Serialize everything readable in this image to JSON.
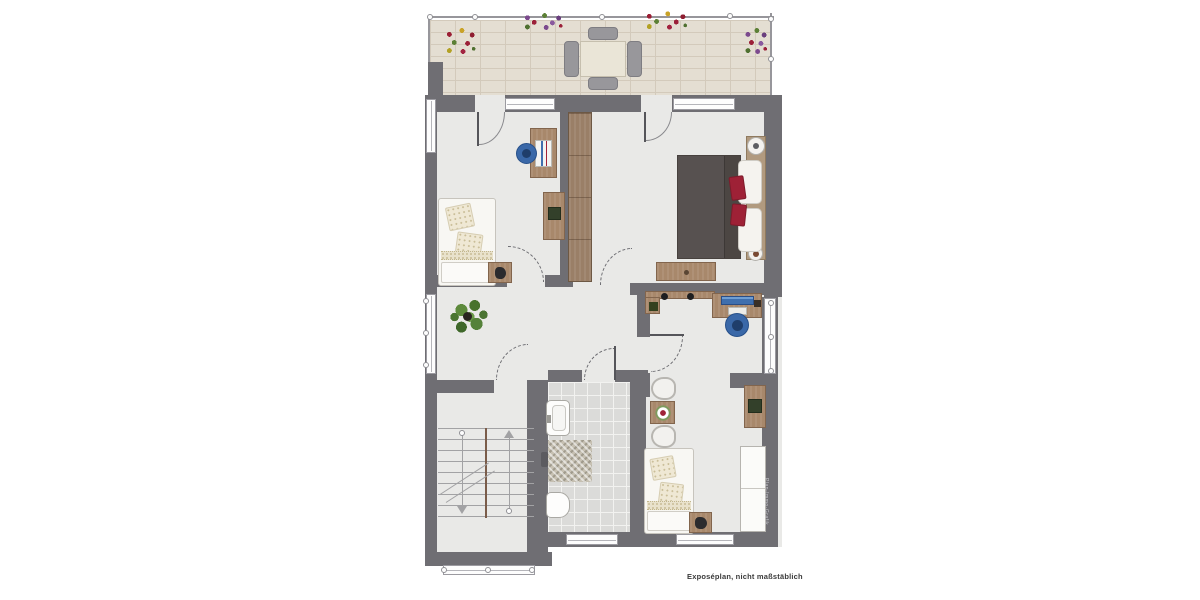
{
  "caption": {
    "text": "Exposéplan, nicht maßstäblich"
  },
  "watermark": {
    "text": "Plan-Immo-Grafik"
  },
  "palette": {
    "wall": "#6f6e73",
    "floor": "#e9e9e7",
    "balcony_tile": "#e4ded2",
    "balcony_grout": "#d3cabb",
    "bath_tile": "#dbdbd9",
    "wood": "#a8886b",
    "wood_dark": "#82654d",
    "wardrobe_wood": "#9a7f67",
    "duvet": "#575150",
    "red_pillow": "#9e2136",
    "chair_blue": "#3a68a8",
    "chair_blue_dark": "#1f3e6b",
    "bed_white": "#f8f7f3",
    "plant_green": "#4a7431",
    "outline": "#97969b"
  },
  "rooms": [
    {
      "name": "balcony",
      "furniture": [
        "dining-table",
        "four-chairs",
        "flower-boxes",
        "railing"
      ]
    },
    {
      "name": "bedroom-top-left",
      "furniture": [
        "single-bed",
        "nightstand",
        "desk",
        "desk-chair",
        "cabinet"
      ]
    },
    {
      "name": "bedroom-top-right",
      "furniture": [
        "double-bed",
        "wardrobe",
        "dresser",
        "bedside-lamps",
        "red-pillows"
      ]
    },
    {
      "name": "study",
      "furniture": [
        "desk",
        "monitor",
        "office-chair",
        "wall-shelf"
      ]
    },
    {
      "name": "hallway",
      "furniture": [
        "potted-plant"
      ]
    },
    {
      "name": "bathroom",
      "furniture": [
        "sink",
        "toilet",
        "shower-mat"
      ]
    },
    {
      "name": "bedroom-bottom-right",
      "furniture": [
        "single-bed",
        "nightstand",
        "two-armchairs",
        "side-table",
        "desk",
        "white-wardrobe"
      ]
    },
    {
      "name": "stairwell",
      "furniture": [
        "staircase-with-arrows"
      ]
    }
  ]
}
